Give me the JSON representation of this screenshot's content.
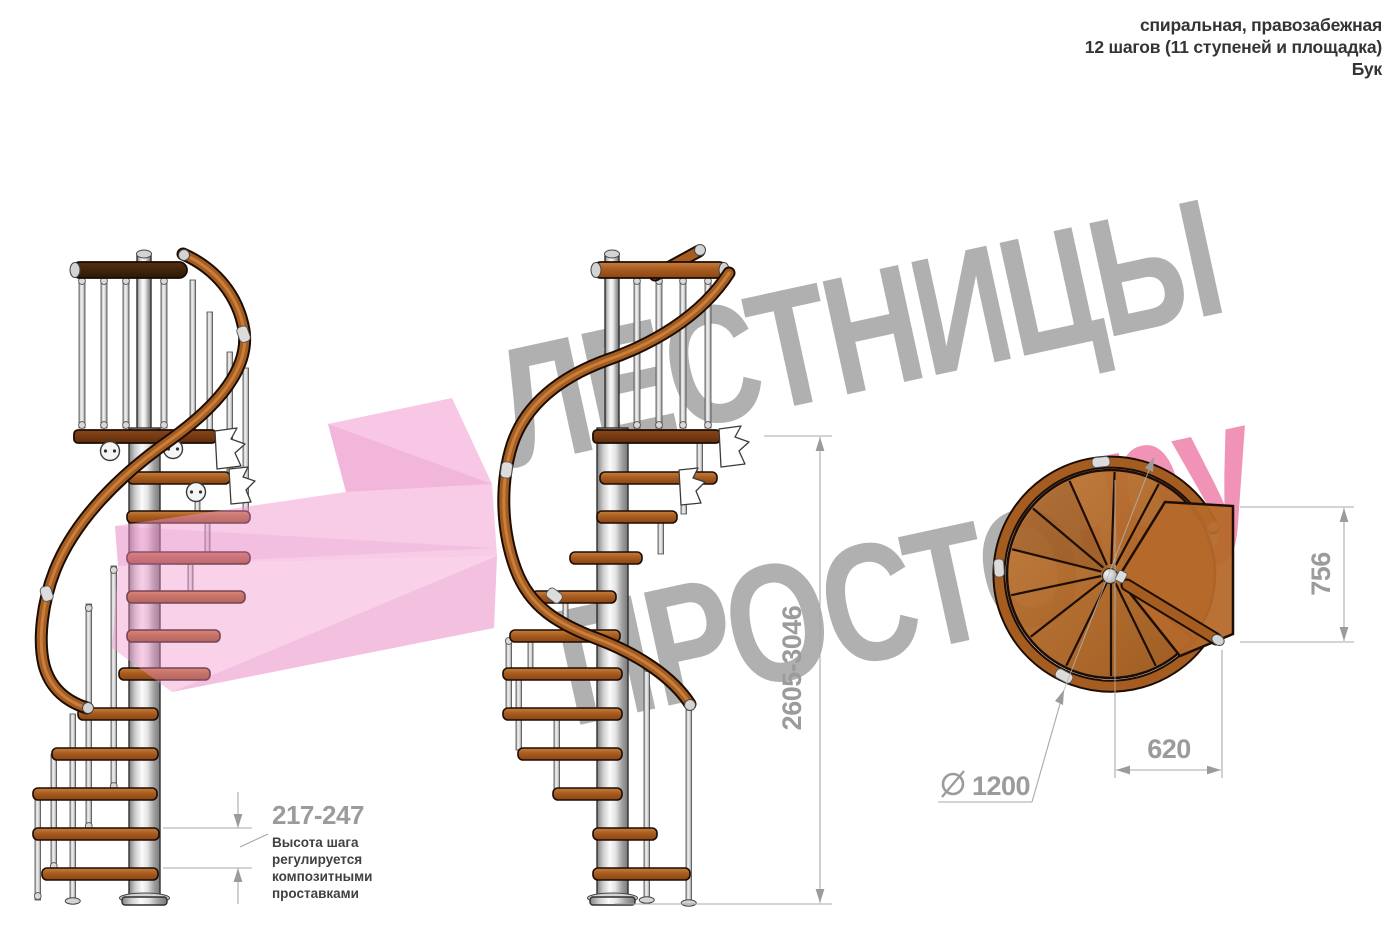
{
  "header": {
    "line1": "спиральная, правозабежная",
    "line2": "12 шагов (11 ступеней и площадка)",
    "line3": "Бук"
  },
  "watermark": {
    "brand_top": "ЛЕСТНИЦЫ",
    "brand_bottom": "ПРОСТО",
    "brand_suffix": ".ру"
  },
  "dimensions": {
    "total_height": "2605-3046",
    "step_height_range": "217-247",
    "landing_depth": "756",
    "landing_width": "620",
    "diameter": "1200"
  },
  "annotation": {
    "line1": "Высота шага",
    "line2": "регулируется",
    "line3": "композитными",
    "line4": "проставками"
  },
  "colors": {
    "wood": "#a85c20",
    "wood_dark": "#6f3310",
    "metal": "#d9d9d9",
    "dimension_gray": "#9b9b9b",
    "watermark_gray": "#a2a2a2",
    "watermark_pink": "#f193b6",
    "logo_pink": "#ef8cc8"
  }
}
